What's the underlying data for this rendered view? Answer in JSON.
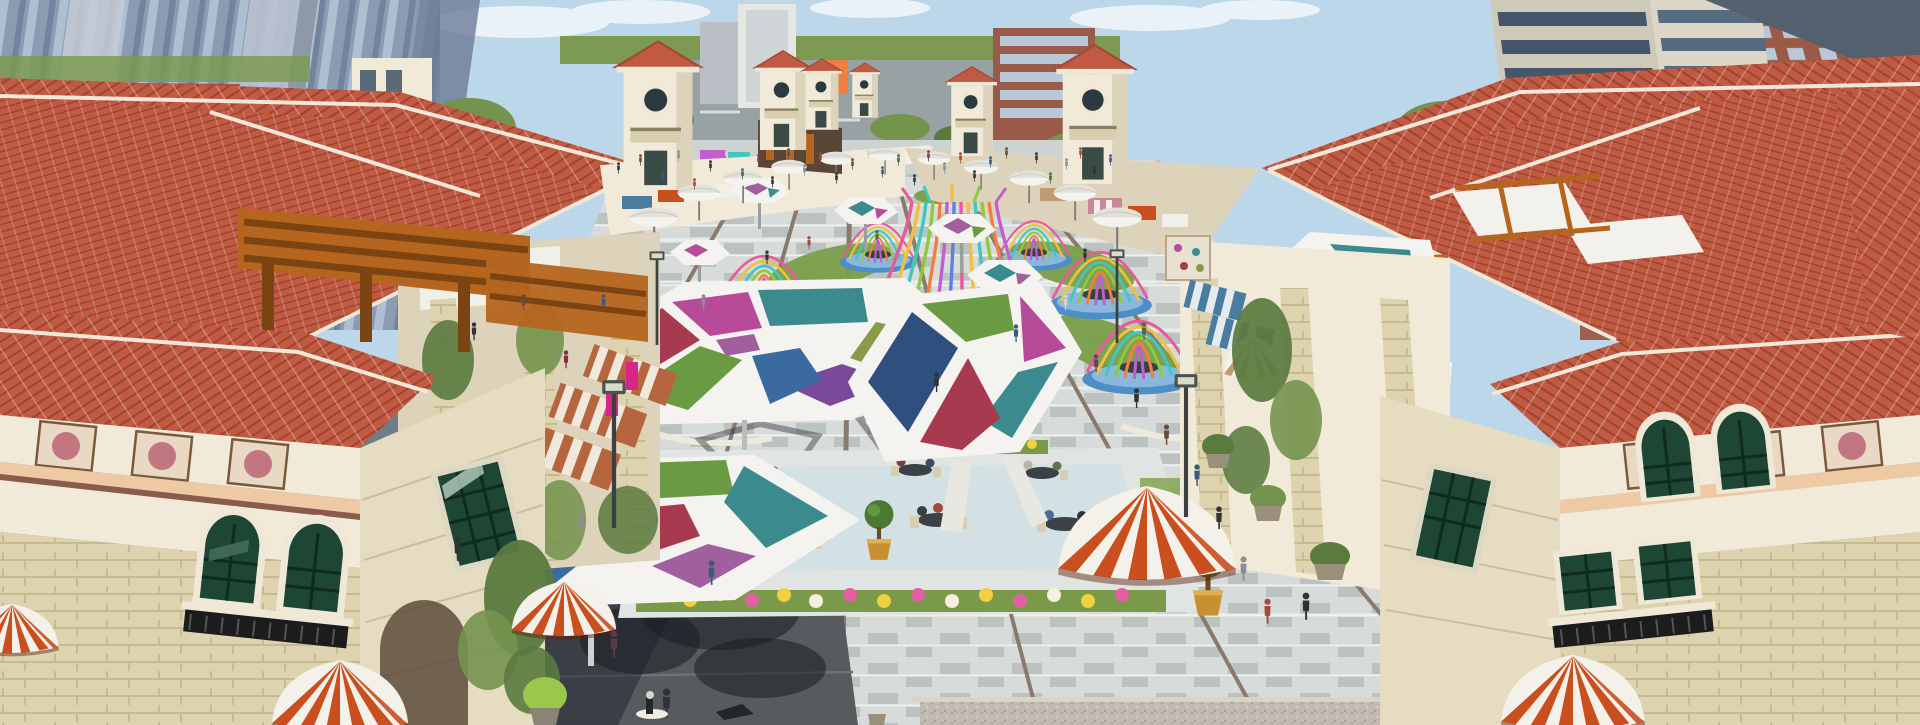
{
  "image": {
    "kind": "3d-architectural-rendering",
    "subject": "Aerial perspective rendering of a Mediterranean-style open-air shopping street and central plaza",
    "features": [
      "terracotta tile roofs",
      "cream stucco facades with decorative tile squares",
      "campanile towers with round windows",
      "red-and-white striped dome awnings",
      "wooden pergolas",
      "stained-glass hexagonal canopies",
      "rainbow ribbon birdcage pavilions on blue mosaic bases",
      "outdoor cafe terrace with round tables and topiary pots",
      "white market umbrellas",
      "pedestrian crowds",
      "glass high-rise towers at left",
      "apartment towers and brick blocks at right",
      "flower beds",
      "gray stone paving with expansion joints"
    ],
    "text_visible": ""
  },
  "palette": {
    "sky": "#bcd7ea",
    "cloud": "#eef5fa",
    "horizonGreen": "#7d9a52",
    "road": "#98a2a4",
    "roadLine": "#d8dcda",
    "glassA": "#8696ad",
    "glassB": "#aebdd0",
    "glassC": "#6b7c96",
    "glassD": "#c6ccd6",
    "towerBeige": "#cfc9ba",
    "towerBeige2": "#dcd6c8",
    "towerWin": "#45566b",
    "brick": "#9a5a48",
    "brickWin": "#b9c8d8",
    "roof": "#c05a42",
    "roofShade": "#a34936",
    "roofLine": "#a0432e",
    "ridgeCream": "#efe8d6",
    "cream": "#f2ead9",
    "creamShade": "#ddd2ba",
    "peach": "#eecaa4",
    "stone": "#ddd3ae",
    "stoneLine": "#c6ba92",
    "stoneDark": "#b9ae8a",
    "glassGreen": "#1d4634",
    "glassGreenLt": "#47705c",
    "iron": "#1c1c1e",
    "paveLight": "#d7dbd9",
    "paveMid": "#bcc2c0",
    "paveDark": "#565b5e",
    "paveJoint": "#8a7a6e",
    "shadow": "rgba(30,36,44,0.50)",
    "awnRed": "#c94f1f",
    "awnWhite": "#f3f1ea",
    "awnBlue": "#4a7ca0",
    "awnSteel": "#3e6a8e",
    "awnPink": "#c98a96",
    "awnTan": "#c09a72",
    "awnTerra": "#b5663f",
    "wood": "#b5651d",
    "woodDark": "#7a4413",
    "lawn": "#7aa04a",
    "tree": "#5a7a3e",
    "treeLt": "#74944e",
    "poolBlue": "#5aa0c8",
    "baseBlue": "#4e8ec6",
    "baseBlueLt": "#8ab8dc",
    "canopyWhite": "#f4f3ef",
    "pCrimson": "#a83a50",
    "pMagenta": "#b84a9a",
    "pPurple": "#7a4a9a",
    "pGreen": "#6a9a42",
    "pTeal": "#3a8a8e",
    "pBlue": "#3a6aa0",
    "pOlive": "#8a9a4a",
    "pNavy": "#2f4f7f",
    "pPlum": "#a060a0",
    "rPink": "#e85a9a",
    "rYellow": "#f0c040",
    "rTeal": "#40c8c0",
    "rGreen": "#90c840",
    "rOrange": "#f08040",
    "rMagenta": "#c060d0",
    "rBlue": "#6080e0",
    "flPink": "#e060a0",
    "flYellow": "#f0d040",
    "flWhite": "#f5f0e0",
    "potGold": "#c89030",
    "deck": "#e0e4e2",
    "gravel": "#c0bab0"
  }
}
